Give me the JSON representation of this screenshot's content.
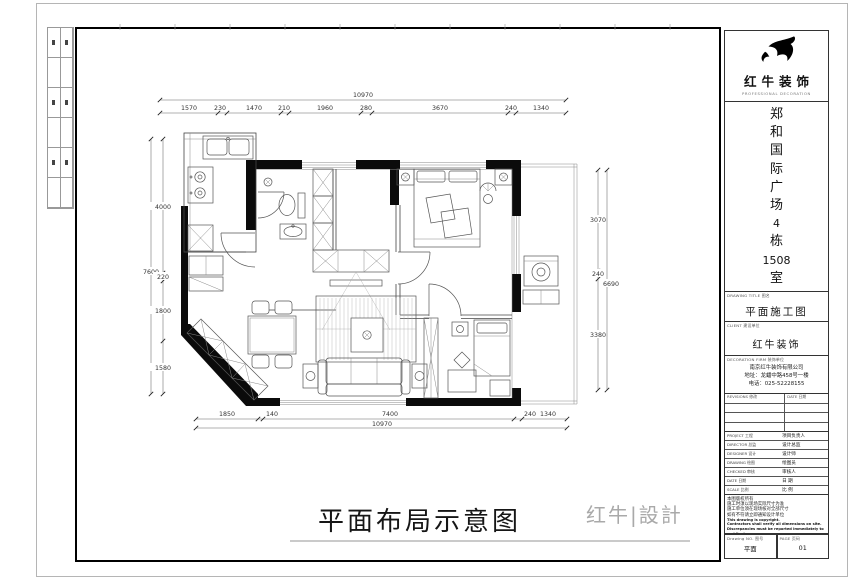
{
  "sheet": {
    "main_title": "平面布局示意图",
    "brand_logo": "红牛|設計"
  },
  "dims": {
    "top_overall": "10970",
    "top_segments": [
      "1570",
      "230",
      "1470",
      "210",
      "1960",
      "280",
      "3670",
      "240",
      "1340"
    ],
    "bottom_overall": "10970",
    "bottom_segments": [
      "1850",
      "140",
      "7400",
      "240",
      "1340"
    ],
    "left_overall": "7600",
    "left_segments": [
      "4000",
      "220",
      "1800",
      "1580"
    ],
    "right_overall": "6690",
    "right_segments": [
      "3070",
      "240",
      "3380"
    ]
  },
  "title_block": {
    "company_name": "红牛装饰",
    "company_tagline": "PROFESSIONAL DECORATION",
    "project_chars": [
      "郑",
      "和",
      "国",
      "际",
      "广",
      "场",
      "4",
      "栋",
      "1508",
      "室"
    ],
    "drawing_title_label": "DRAWING TITLE 图名",
    "drawing_title": "平面施工图",
    "client_label": "CLIENT 建设单位",
    "client_name": "红牛装饰",
    "firm_label": "DECORATION FIRM 装饰单位",
    "firm_lines": [
      "南京红牛装饰有限公司",
      "地址：龙蟠中路458号一楼",
      "电话：025-52228155"
    ],
    "revisions_label": "REVISIONS 修改",
    "revisions_date_label": "DATE 日期",
    "info_rows": [
      {
        "en": "PROJECT 工程",
        "zh": "项目负责人"
      },
      {
        "en": "DIRECTOR 总监",
        "zh": "设计总监"
      },
      {
        "en": "DESIGNER 设计",
        "zh": "设计师"
      },
      {
        "en": "DRAWING 绘图",
        "zh": "绘图员"
      },
      {
        "en": "CHECKED 审核",
        "zh": "审核人"
      },
      {
        "en": "DATE 日期",
        "zh": "日 期"
      },
      {
        "en": "SCALE 比例",
        "zh": "比 例"
      }
    ],
    "notes": [
      "本图版权所有",
      "施工时须以现场实际尺寸为准",
      "施工单位须在现场核对全部尺寸",
      "如有不符请立即通知设计单位",
      "This drawing is copyright.",
      "Contractors shall verify all dimensions on site.",
      "Discrepancies must be reported immediately to architect."
    ],
    "drawing_no_label": "Drawing NO. 图号",
    "drawing_no_value": "平面",
    "page_label": "PAGE 页码",
    "page_value": "01"
  }
}
